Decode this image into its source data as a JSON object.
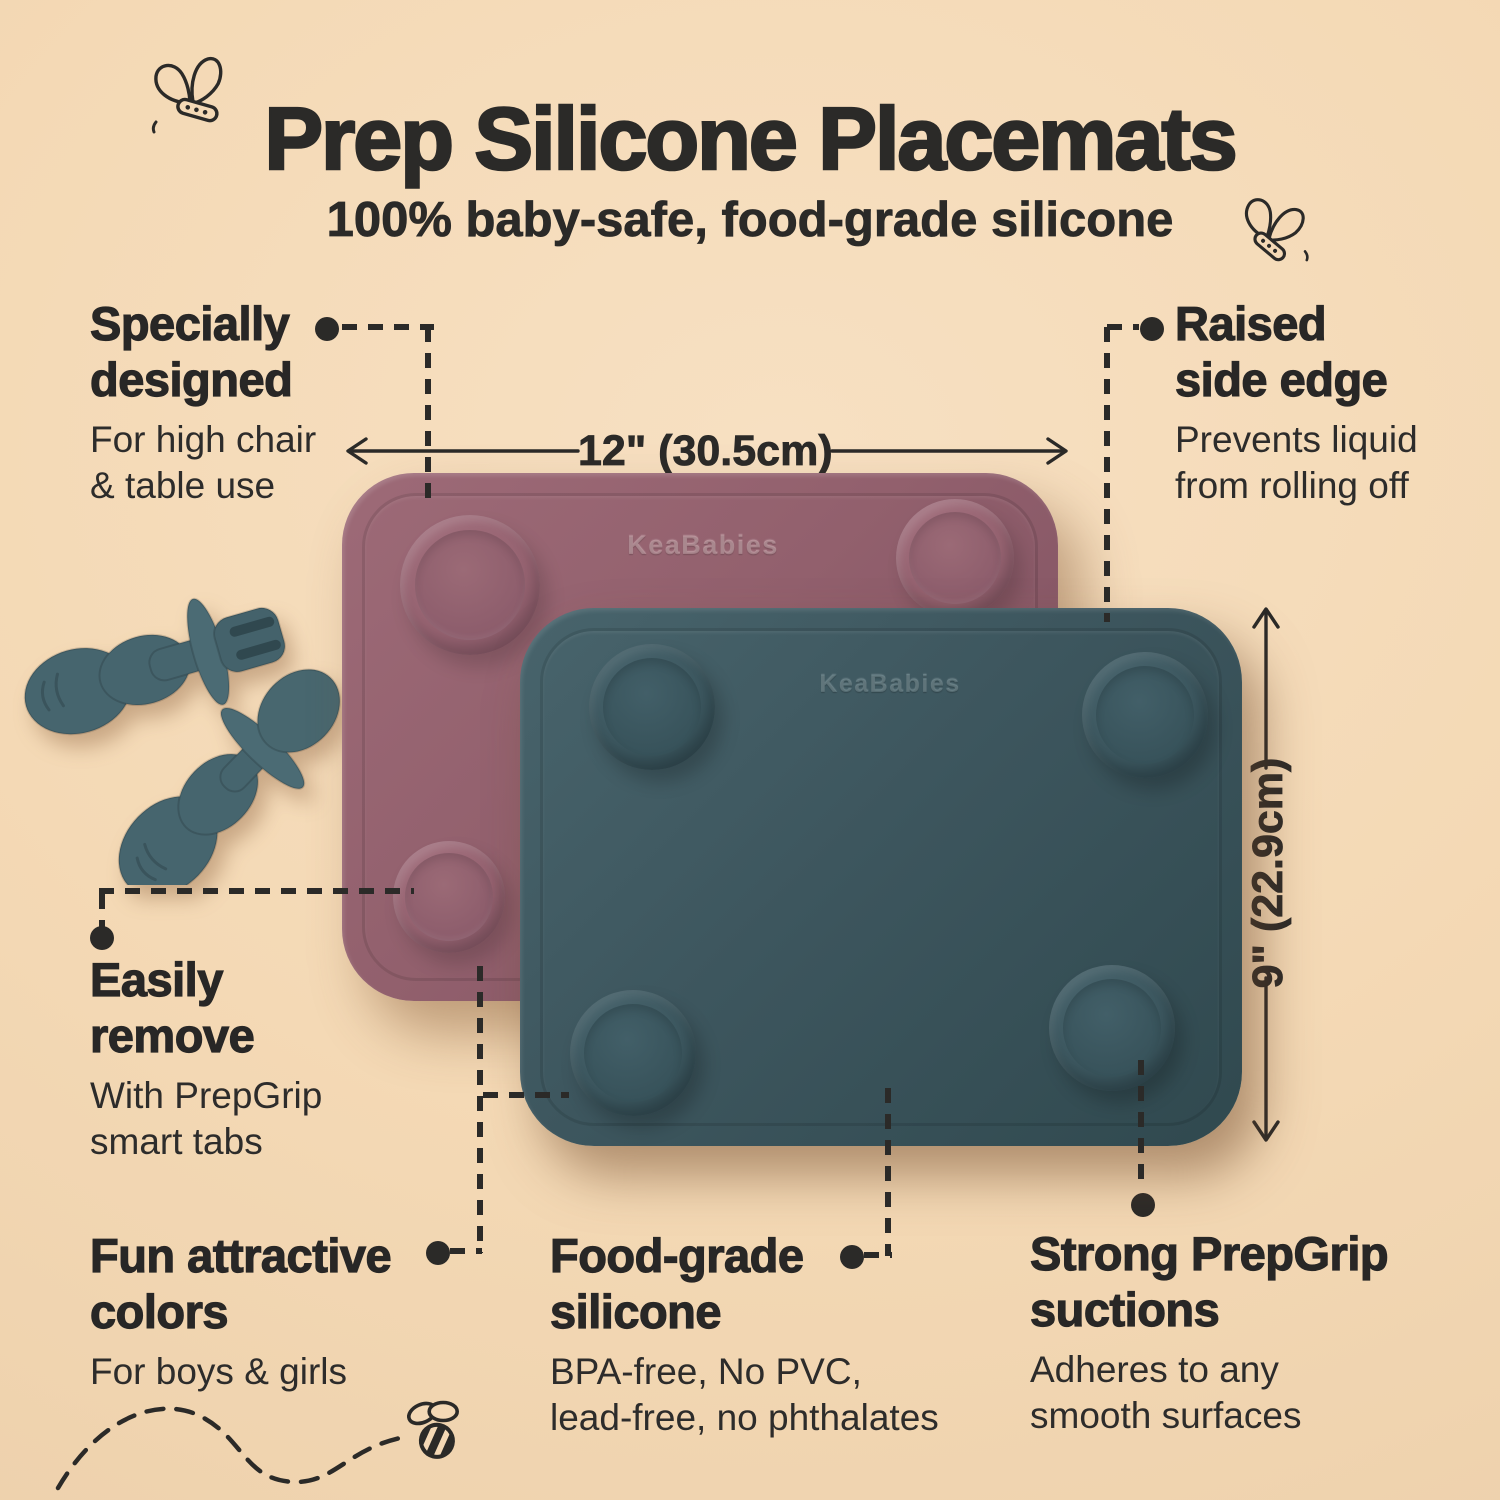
{
  "header": {
    "title": "Prep Silicone Placemats",
    "subtitle": "100% baby-safe, food-grade silicone"
  },
  "brand": {
    "logo": "KeaBabies"
  },
  "dimensions": {
    "width_label": "12\" (30.5cm)",
    "height_label": "9\" (22.9cm)"
  },
  "features": [
    {
      "id": "specially-designed",
      "heading_lines": [
        "Specially",
        "designed"
      ],
      "body_lines": [
        "For high chair",
        "& table use"
      ]
    },
    {
      "id": "raised-side-edge",
      "heading_lines": [
        "Raised",
        "side edge"
      ],
      "body_lines": [
        "Prevents liquid",
        "from rolling off"
      ]
    },
    {
      "id": "easily-remove",
      "heading_lines": [
        "Easily",
        "remove"
      ],
      "body_lines": [
        "With PrepGrip",
        "smart tabs"
      ]
    },
    {
      "id": "fun-attractive-colors",
      "heading_lines": [
        "Fun attractive",
        "colors"
      ],
      "body_lines": [
        "For boys & girls"
      ]
    },
    {
      "id": "food-grade-silicone",
      "heading_lines": [
        "Food-grade",
        "silicone"
      ],
      "body_lines": [
        "BPA-free, No PVC,",
        "lead-free, no phthalates"
      ]
    },
    {
      "id": "strong-prepgrip-suctions",
      "heading_lines": [
        "Strong PrepGrip",
        "suctions"
      ],
      "body_lines": [
        "Adheres to any",
        "smooth surfaces"
      ]
    }
  ],
  "icons": {
    "butterfly": "butterfly-line-doodle",
    "bee": "bee-line-doodle",
    "utensils": "baby-fork-and-spoon"
  },
  "colors": {
    "background": "#f4d9b5",
    "text": "#2b2a28",
    "mauve_mat": "#92606d",
    "teal_mat": "#3d565e",
    "utensils": "#46656e"
  }
}
